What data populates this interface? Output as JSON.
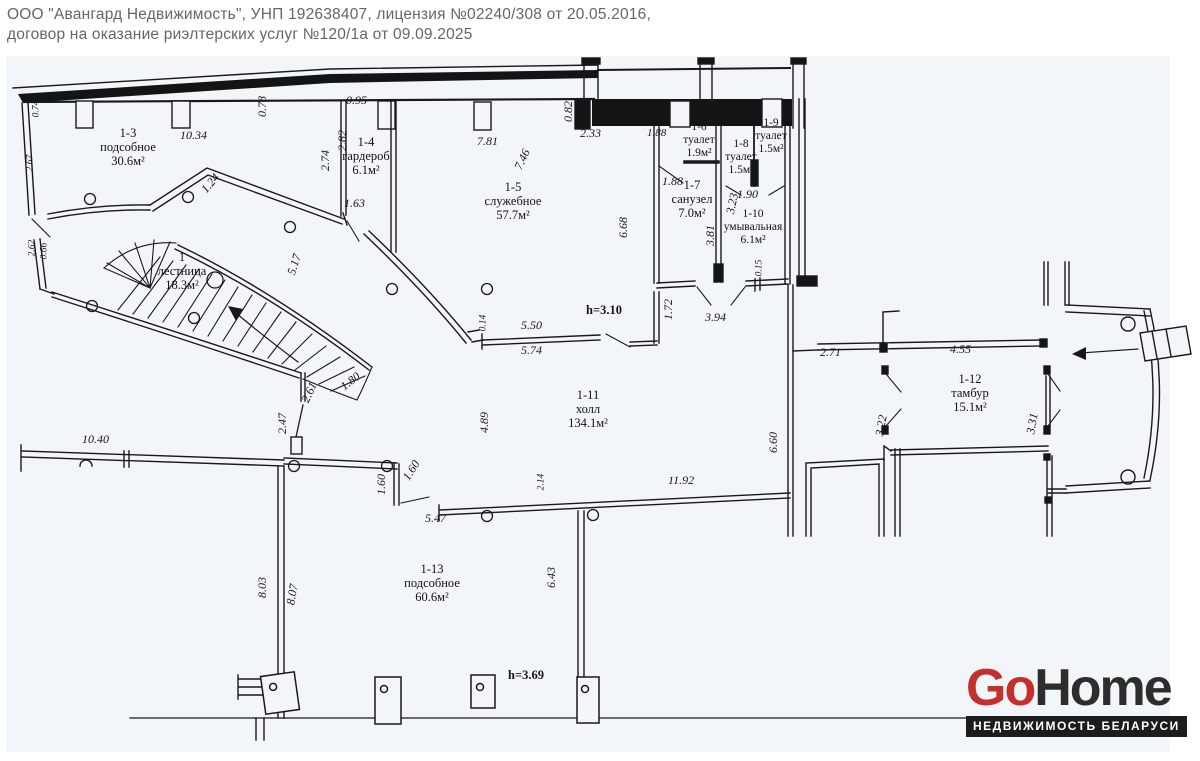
{
  "header": {
    "line1": "ООО \"Авангард Недвижимость\", УНП 192638407, лицензия №02240/308 от 20.05.2016,",
    "line2": "договор на оказание риэлтерских услуг №120/1а от 09.09.2025"
  },
  "logo": {
    "go": "Go",
    "home": "Home",
    "tagline": "НЕДВИЖИМОСТЬ БЕЛАРУСИ"
  },
  "rooms": [
    {
      "id": "1-3",
      "name": "подсобное",
      "area": "30.6м²"
    },
    {
      "id": "1-4",
      "name": "гардероб",
      "area": "6.1м²"
    },
    {
      "id": "1-5",
      "name": "служебное",
      "area": "57.7м²"
    },
    {
      "id": "1-6",
      "name": "туалет",
      "area": "1.9м²"
    },
    {
      "id": "1-7",
      "name": "санузел",
      "area": "7.0м²"
    },
    {
      "id": "1-8",
      "name": "туалет",
      "area": "1.5м²"
    },
    {
      "id": "1-9",
      "name": "туалет",
      "area": "1.5м²"
    },
    {
      "id": "1-10",
      "name": "умывальная",
      "area": "6.1м²"
    },
    {
      "id": "1-11",
      "name": "холл",
      "area": "134.1м²"
    },
    {
      "id": "1-12",
      "name": "тамбур",
      "area": "15.1м²"
    },
    {
      "id": "1-13",
      "name": "подсобное",
      "area": "60.6м²"
    },
    {
      "id": "1",
      "name": "лестница",
      "area": "18.3м²"
    }
  ],
  "dims": {
    "d074": "0.74",
    "d267": "2.67",
    "d262": "2.62",
    "d066": "0.66",
    "d078": "0.78",
    "d1034": "10.34",
    "d095": "0.95",
    "d282": "2.82",
    "d274": "2.74",
    "d124": "1.24",
    "d163": "1.63",
    "d781": "7.81",
    "d746": "7.46",
    "d233": "2.33",
    "d082": "0.82",
    "d188a": "1.88",
    "d188b": "1.88",
    "d190": "1.90",
    "d323": "3.23",
    "d381": "3.81",
    "d015": "0.15",
    "d668": "6.68",
    "d517": "5.17",
    "d550": "5.50",
    "d574": "5.74",
    "dh310": "h=3.10",
    "d014": "0.14",
    "d172": "1.72",
    "d394": "3.94",
    "d271": "2.71",
    "d455": "4.55",
    "d489": "4.89",
    "d660": "6.60",
    "d322": "3.22",
    "d331": "3.31",
    "d247": "2.47",
    "d261": "2.61",
    "d180": "1.80",
    "d1040": "10.40",
    "d1192": "11.92",
    "d160a": "1.60",
    "d160b": "1.60",
    "d214": "2.14",
    "d547": "5.47",
    "d803": "8.03",
    "d807": "8.07",
    "d643": "6.43",
    "dh369": "h=3.69"
  }
}
